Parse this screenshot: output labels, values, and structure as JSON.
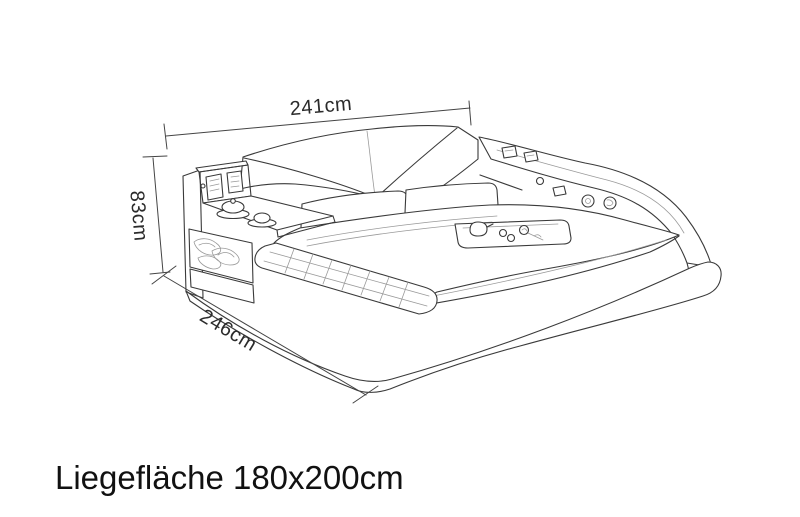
{
  "diagram": {
    "caption": "Liegefläche 180x200cm",
    "dimensions": {
      "width": "241cm",
      "height": "83cm",
      "depth": "246cm"
    },
    "colors": {
      "background": "#ffffff",
      "line": "#3a3a3a",
      "headboard": "#f1ecca",
      "control_panel": "#1d1d1d",
      "text": "#111111"
    }
  }
}
